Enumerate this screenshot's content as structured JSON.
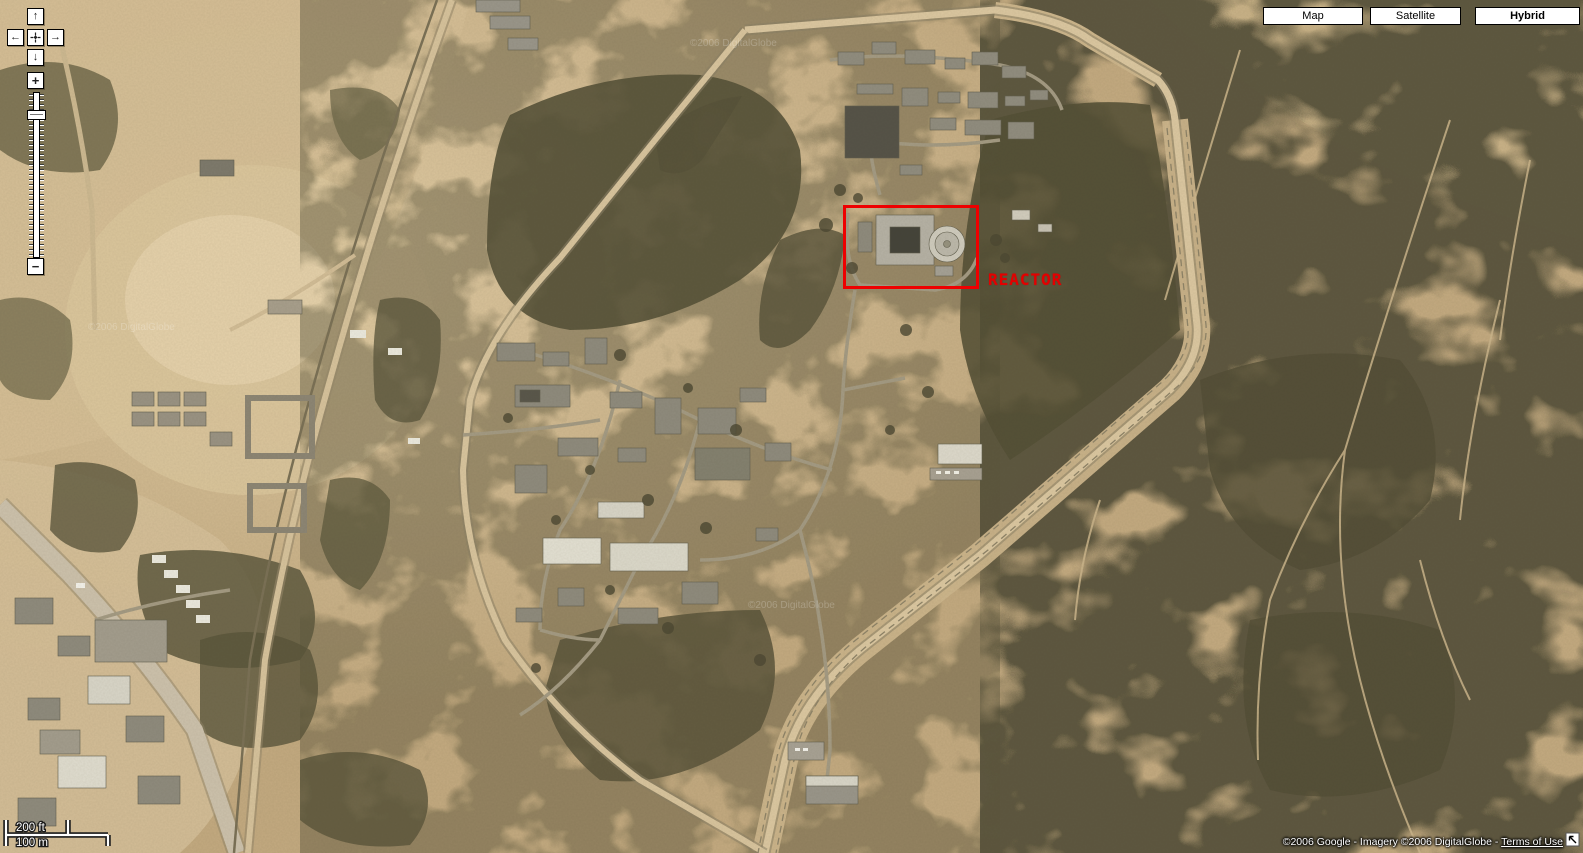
{
  "pan_control": {
    "up_icon": "↑",
    "down_icon": "↓",
    "left_icon": "←",
    "right_icon": "→"
  },
  "zoom_control": {
    "zoom_in": "+",
    "zoom_out": "−"
  },
  "map_type_buttons": [
    {
      "label": "Map",
      "active": false
    },
    {
      "label": "Satellite",
      "active": false
    },
    {
      "label": "Hybrid",
      "active": true
    }
  ],
  "scale_bar": {
    "imperial": "200 ft",
    "metric": "100 m"
  },
  "attribution": {
    "copyright": "©2006 Google - Imagery ©2006 DigitalGlobe - ",
    "terms_link": "Terms of Use",
    "watermark": "©2006 DigitalGlobe"
  },
  "annotation": {
    "label": "REACTOR",
    "box_color": "#ee0000"
  }
}
